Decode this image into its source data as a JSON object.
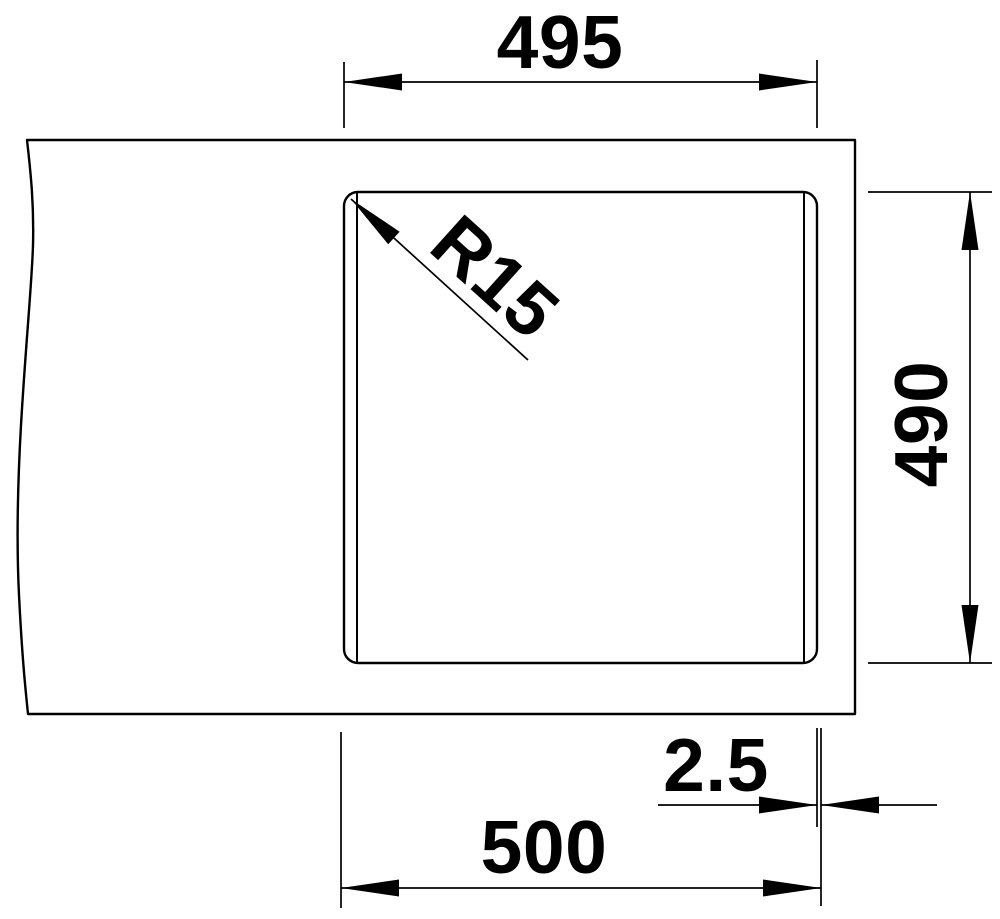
{
  "drawing": {
    "background": "#ffffff",
    "line_color": "#000000",
    "labels": {
      "width_top": "495",
      "corner_radius": "R15",
      "depth": "490",
      "rim_offset": "2.5",
      "width_overall": "500"
    }
  }
}
